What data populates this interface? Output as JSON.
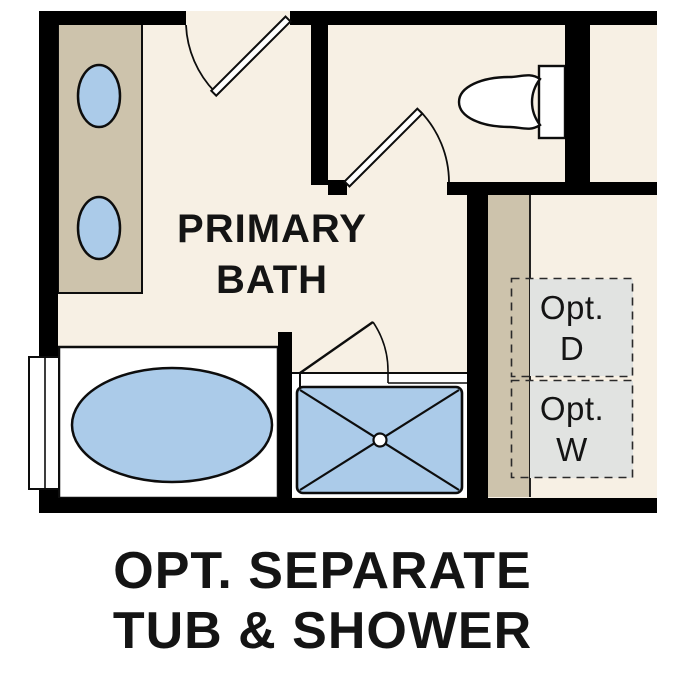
{
  "room_label": {
    "line1": "PRIMARY",
    "line2": "BATH"
  },
  "caption": {
    "line1": "OPT. SEPARATE",
    "line2": "TUB & SHOWER"
  },
  "closet": {
    "dryer": {
      "line1": "Opt.",
      "line2": "D"
    },
    "washer": {
      "line1": "Opt.",
      "line2": "W"
    }
  },
  "colors": {
    "wall": "#000000",
    "floor": "#f7f0e4",
    "counter": "#cdc3ac",
    "blue": "#abcbe9",
    "gray": "#e1e3e1",
    "ink": "#141414",
    "paper": "#ffffff",
    "stroke": "#0d0d0d"
  }
}
